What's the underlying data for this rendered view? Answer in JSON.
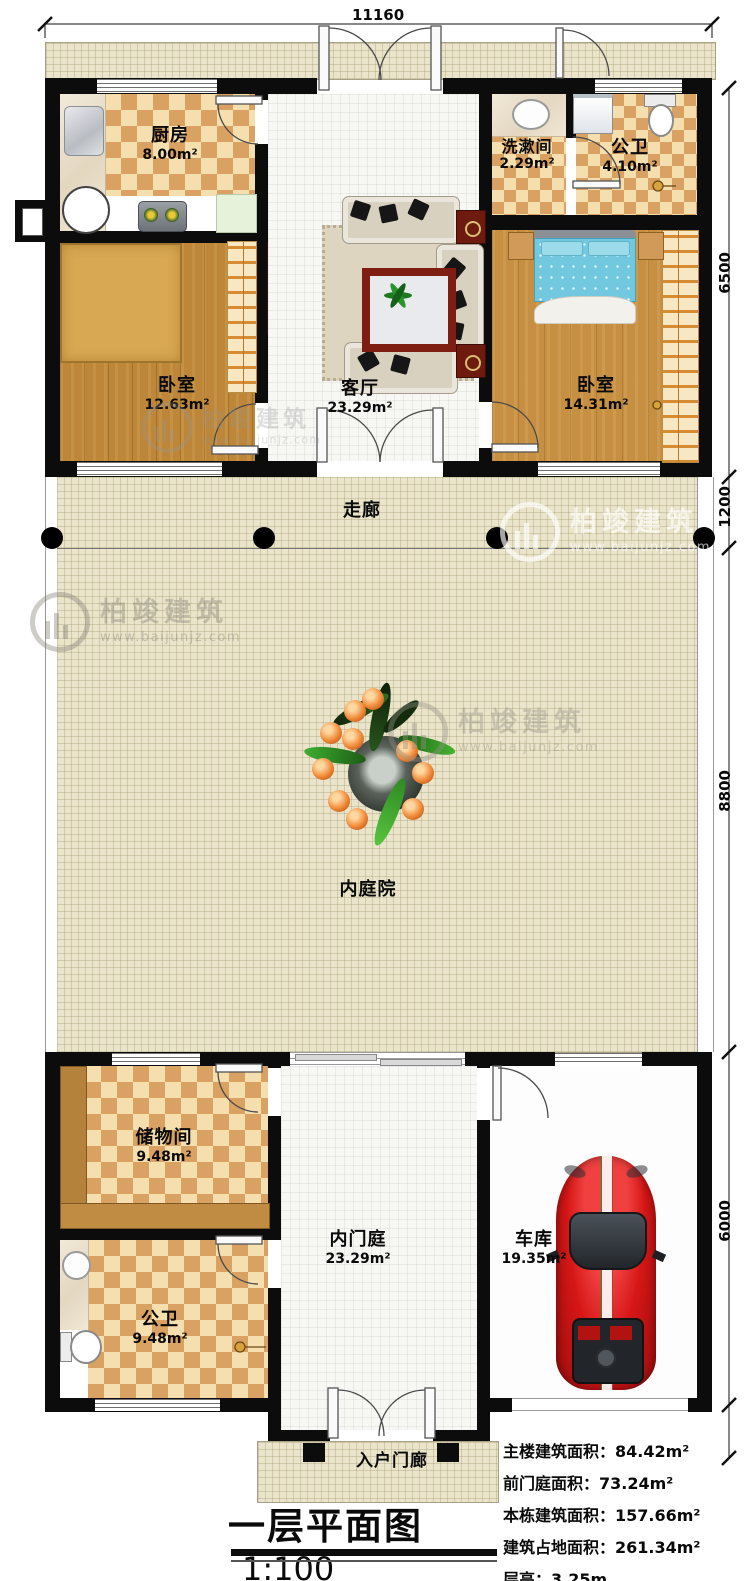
{
  "meta": {
    "title_text": "一层平面图",
    "scale_text": "1:100"
  },
  "dims": {
    "top": "11160",
    "right": [
      "6500",
      "1200",
      "8800",
      "6000"
    ]
  },
  "rooms": {
    "kitchen": {
      "name": "厨房",
      "area": "8.00m²"
    },
    "washroom": {
      "name": "洗漱间",
      "area": "2.29m²"
    },
    "bath_top": {
      "name": "公卫",
      "area": "4.10m²"
    },
    "bedroom_left": {
      "name": "卧室",
      "area": "12.63m²"
    },
    "living": {
      "name": "客厅",
      "area": "23.29m²"
    },
    "bedroom_right": {
      "name": "卧室",
      "area": "14.31m²"
    },
    "corridor": {
      "name": "走廊"
    },
    "courtyard": {
      "name": "内庭院"
    },
    "storage": {
      "name": "储物间",
      "area": "9.48m²"
    },
    "bath_bottom": {
      "name": "公卫",
      "area": "9.48m²"
    },
    "foyer": {
      "name": "内门庭",
      "area": "23.29m²"
    },
    "garage": {
      "name": "车库",
      "area": "19.35m²"
    },
    "porch": {
      "name": "入户门廊"
    }
  },
  "stats": {
    "lines": [
      {
        "label": "主楼建筑面积：",
        "value": "84.42m²"
      },
      {
        "label": "前门庭面积：",
        "value": "73.24m²"
      },
      {
        "label": "本栋建筑面积：",
        "value": "157.66m²"
      },
      {
        "label": "建筑占地面积：",
        "value": "261.34m²"
      },
      {
        "label": "层高：",
        "value": "3.25m"
      }
    ]
  },
  "watermark": {
    "brand": "柏竣建筑",
    "site": "www.baijunjz.com"
  },
  "colors": {
    "wall": "#0c0c0c",
    "courtyard": "#eae5ca",
    "checker": "#d9a262",
    "car": "#d61616",
    "bed": "#72c8de"
  }
}
